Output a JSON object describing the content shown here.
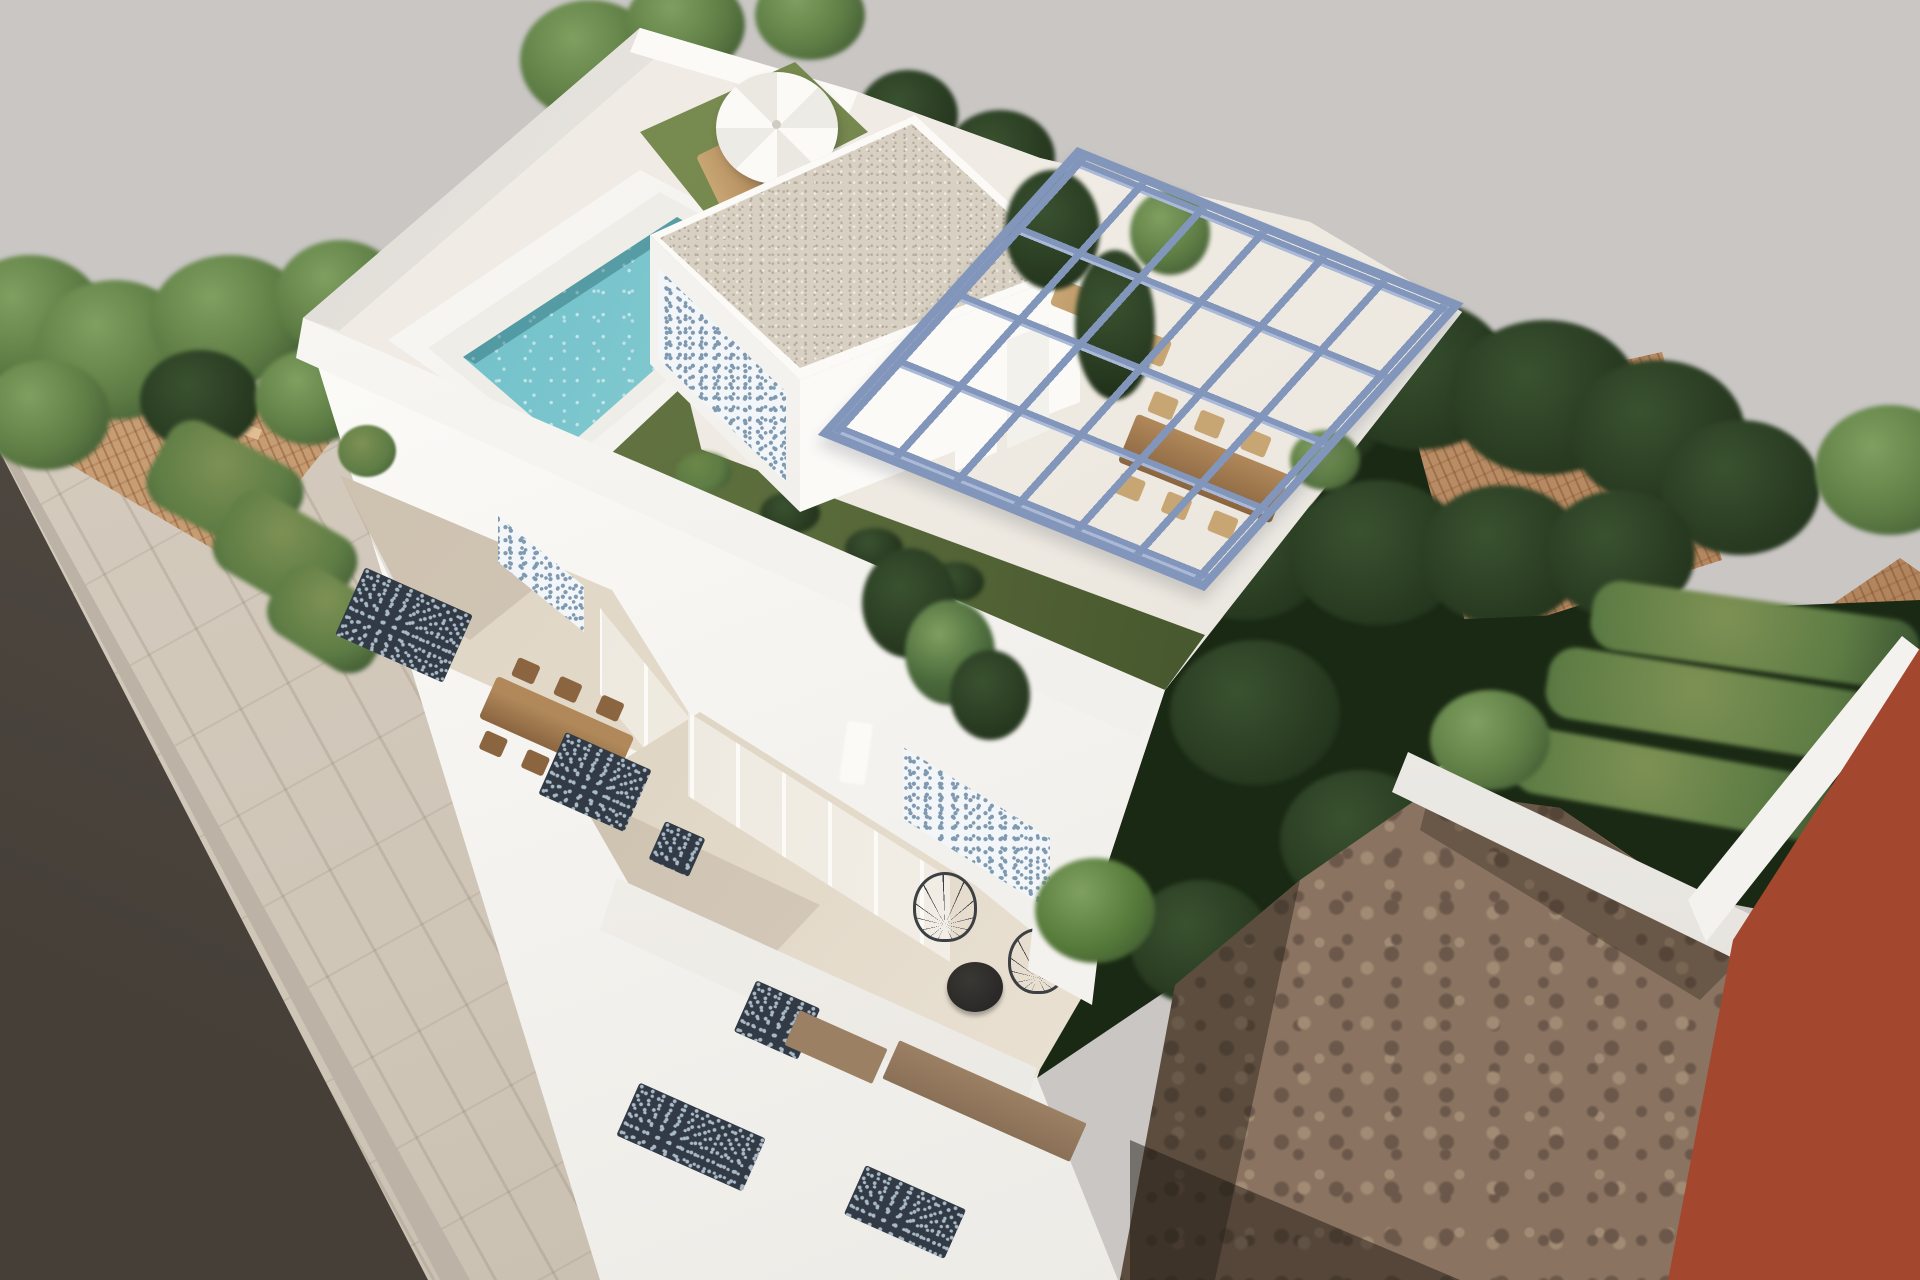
{
  "scene": {
    "type": "architectural_3d_render",
    "subject": "Aerial 3D rendering of a modern white two-storey villa with rooftop terrace",
    "rooftop": {
      "pool": "rectangular swimming pool with white coping and turquoise mosaic water",
      "sun_area": "white parasol with wooden sun loungers and a small round table on artificial turf",
      "penthouse": "white roof structure with beige gravel flat roof, blue-and-white patterned tile accent wall and white doors",
      "pergola": "steel-blue open pergola frame over the roof terrace",
      "turf_band": "dark green artificial turf strip with ornamental grasses wrapping the roof deck",
      "furniture": "long wooden outdoor dining table with wooden chairs and two wooden sun loungers"
    },
    "middle_floor": {
      "terrace": "recessed terrace with long wooden dining table and chairs",
      "accent_wall": "blue-and-white patterned tile panel beside glazed sliding doors",
      "plant": "green potted plant at terrace corner"
    },
    "lower_floor": {
      "terrace": "street-level roof terrace with black round table and two black wire chairs",
      "accent_wall": "blue-and-white patterned tile panel and glazed sliding doors with white curtain",
      "planter": "white planter with green tropical plant",
      "facade_accents": "dark patterned balcony openings and sand-brown bands on the white street facade"
    },
    "surroundings": {
      "street": "dark asphalt road with light tiled pavement along the facade",
      "left_neighbour": "terracotta hip roof house surrounded by green trees and hedges",
      "right_neighbour": "terracotta tiled roof behind a dense mass of dark green trees",
      "rear_right": "empty brown dirt plot, low white garden walls, hedge rows and a terracotta-red building at the right edge"
    }
  },
  "palette": {
    "bg": "#c9c6c4",
    "road": "#57504a",
    "road-dark": "#453f38",
    "sidewalk": "#cfc5b7",
    "curb": "#bcb3a6",
    "white": "#f4f2ee",
    "white-bright": "#fbfaf7",
    "white-shadow": "#e0ddd7",
    "fascia": "#f1efeb",
    "roof-floor": "#eae4da",
    "terrace-floor": "#e7decf",
    "gravel": "#d7d0c3",
    "gravel-dot-dark": "#b6ab9a",
    "gravel-dot-light": "#f0ebe0",
    "water-deep": "#5fb7c4",
    "water-mid": "#8fd0d4",
    "water-light": "#c3e6e3",
    "coping": "#efede8",
    "grass": "#6d7f48",
    "grass-dark": "#49592f",
    "grass-bright": "#7e9154",
    "tree-light": "#7fa060",
    "tree-mid": "#5d7c44",
    "tree-dark": "#3a5230",
    "tree-deep": "#26381f",
    "tree-shadow": "#1a2914",
    "terracotta": "#c79d74",
    "terracotta-dark": "#a87b54",
    "pergola": "#8296bb",
    "pergola-light": "#aab9d8",
    "wood": "#b0885a",
    "wood-dark": "#8a6540",
    "chair-wood": "#c8a674",
    "mosaic-blue": "#7e99b0",
    "mosaic-bg": "#f3f6f8",
    "accent-dark": "#313a45",
    "accent-dot": "#a9b9c6",
    "band-brown": "#9c8064",
    "dirt": "#8a7361",
    "dirt-dark": "#6b584a",
    "dirt-light": "#a28b74",
    "red-building": "#9b432a",
    "black-furniture": "#2b2927",
    "wire": "#3c4043",
    "glass": "#e8e2d6"
  }
}
